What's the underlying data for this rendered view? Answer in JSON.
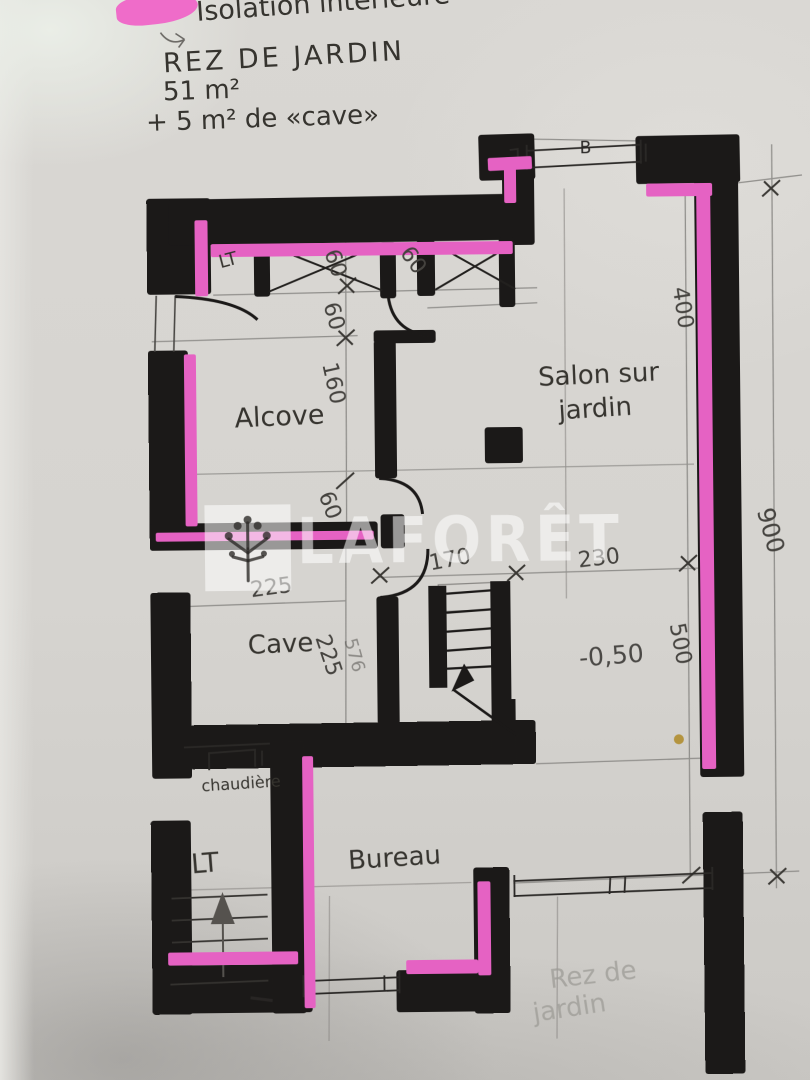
{
  "annotations": {
    "line1": "Isolation intérieure",
    "line2": "REZ DE JARDIN",
    "line3": "51 m²",
    "line4": "+ 5 m² de «cave»"
  },
  "rooms": {
    "alcove": "Alcove",
    "salon_line1": "Salon sur",
    "salon_line2": "jardin",
    "cave": "Cave",
    "bureau": "Bureau",
    "boiler": "chaudière",
    "lt_lower": "LT",
    "lt_upper": "LT"
  },
  "levels": {
    "salon_level": "-0,50"
  },
  "dimensions": {
    "d60a": "60",
    "d60b": "60",
    "d60c": "60",
    "d60d": "60",
    "d160": "160",
    "d225h": "225",
    "d225v": "225",
    "scribble": "576",
    "d170": "170",
    "d230": "230",
    "d400": "400",
    "d500": "500",
    "d900": "900",
    "window_mark": "B"
  },
  "watermark": {
    "brand": "LAFORÊT"
  },
  "footnote": {
    "line1": "Rez de",
    "line2": "jardin"
  },
  "colors": {
    "highlight_pink": "#e562c3",
    "ink_black": "#1b1918",
    "pencil_gray": "#8a8885"
  }
}
